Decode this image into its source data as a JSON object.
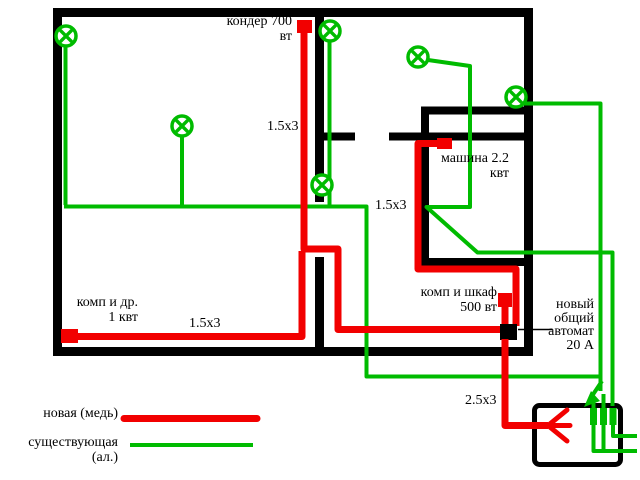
{
  "labels": {
    "conditioner": "кондер 700\nвт",
    "machine": "машина 2.2\nквт",
    "comp_other": "комп и др.\n1 квт",
    "comp_cabinet": "комп и шкаф\n500 вт",
    "breaker": "новый\nобщий\nавтомат\n20 А",
    "cable_conditioner": "1.5x3",
    "cable_machine": "1.5x3",
    "cable_comp": "1.5x3",
    "cable_feed": "2.5x3"
  },
  "legend": {
    "new": {
      "label": "новая (медь)",
      "color": "#f20000"
    },
    "existing": {
      "label": "существующая\n(ал.)",
      "color": "#00bb00"
    }
  },
  "colors": {
    "wall": "#000000",
    "new_wire": "#f20000",
    "existing_wire": "#00bb00",
    "background": "#ffffff"
  },
  "counts": {
    "lamps": 6,
    "panel_breakers": 3
  }
}
